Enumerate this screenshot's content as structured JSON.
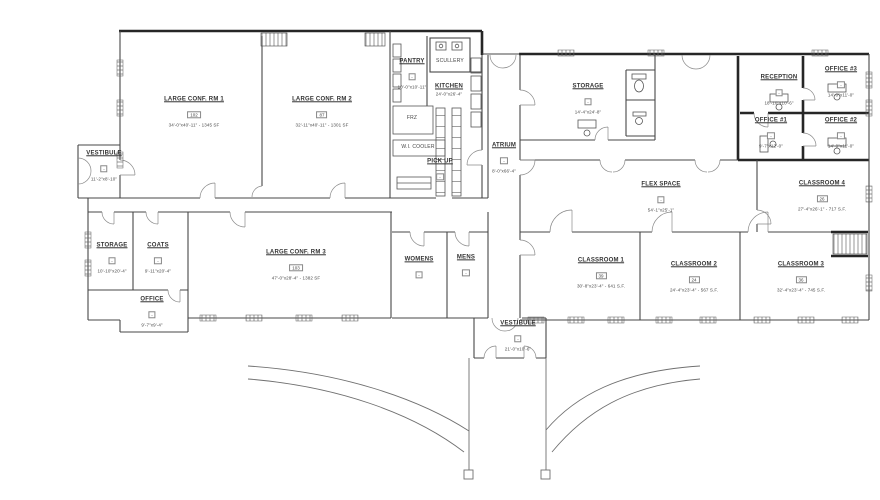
{
  "drawing": {
    "kind": "architectural floor plan",
    "background_color": "#ffffff",
    "line_color": "#4a4a4a",
    "thick_wall_color": "#262626",
    "canvas": {
      "width": 880,
      "height": 500
    }
  },
  "rooms": [
    {
      "type": "room",
      "name": "LARGE CONF. RM 1",
      "number": "102",
      "dims": "34'-0\"x40'-11\" - 1345 SF",
      "x": 194,
      "y": 112
    },
    {
      "type": "room",
      "name": "LARGE CONF. RM 2",
      "number": "87",
      "dims": "32'-11\"x40'-11\" - 1301 SF",
      "x": 322,
      "y": 112
    },
    {
      "type": "room",
      "name": "VESTIBULE",
      "number": "-",
      "dims": "11'-2\"x8'-10\"",
      "x": 104,
      "y": 166
    },
    {
      "type": "room",
      "name": "STORAGE",
      "number": "-",
      "dims": "10'-10\"x20'-4\"",
      "x": 112,
      "y": 258
    },
    {
      "type": "room",
      "name": "COATS",
      "number": "-",
      "dims": "9'-11\"x20'-4\"",
      "x": 158,
      "y": 258
    },
    {
      "type": "room",
      "name": "OFFICE",
      "number": "-",
      "dims": "9'-7\"x9'-4\"",
      "x": 152,
      "y": 312
    },
    {
      "type": "room",
      "name": "LARGE CONF. RM 3",
      "number": "103",
      "dims": "47'-0\"x28'-4\" - 1382 SF",
      "x": 296,
      "y": 265
    },
    {
      "type": "room",
      "name": "PANTRY",
      "number": "-",
      "dims": "10'-0\"x10'-11\"",
      "x": 412,
      "y": 74
    },
    {
      "type": "equip",
      "name": "SCULLERY",
      "number": "",
      "dims": "",
      "x": 450,
      "y": 62
    },
    {
      "type": "room",
      "name": "KITCHEN",
      "number": "",
      "dims": "24'-0\"x26'-4\"",
      "x": 449,
      "y": 90
    },
    {
      "type": "equip",
      "name": "FRZ",
      "number": "",
      "dims": "",
      "x": 412,
      "y": 119
    },
    {
      "type": "equip",
      "name": "W.I. COOLER",
      "number": "",
      "dims": "",
      "x": 418,
      "y": 148
    },
    {
      "type": "room",
      "name": "PICK UP",
      "number": "-",
      "dims": "",
      "x": 440,
      "y": 171
    },
    {
      "type": "room",
      "name": "ATRIUM",
      "number": "-",
      "dims": "8'-0\"x66'-4\"",
      "x": 504,
      "y": 158
    },
    {
      "type": "room",
      "name": "STORAGE",
      "number": "-",
      "dims": "14'-4\"x24'-8\"",
      "x": 588,
      "y": 99
    },
    {
      "type": "room",
      "name": "RECEPTION",
      "number": "-",
      "dims": "18'-10\"x10'-6\"",
      "x": 779,
      "y": 90
    },
    {
      "type": "room",
      "name": "OFFICE #3",
      "number": "-",
      "dims": "14'-0\"x11'-0\"",
      "x": 841,
      "y": 82
    },
    {
      "type": "room",
      "name": "OFFICE #1",
      "number": "-",
      "dims": "9'-7\"x12'-0\"",
      "x": 771,
      "y": 133
    },
    {
      "type": "room",
      "name": "OFFICE #2",
      "number": "-",
      "dims": "14'-0\"x11'-0\"",
      "x": 841,
      "y": 133
    },
    {
      "type": "room",
      "name": "FLEX SPACE",
      "number": "-",
      "dims": "54'-1\"x25'-1\"",
      "x": 661,
      "y": 197
    },
    {
      "type": "room",
      "name": "CLASSROOM 4",
      "number": "26",
      "dims": "27'-4\"x26'-1\" - 717 S.F.",
      "x": 822,
      "y": 196
    },
    {
      "type": "room",
      "name": "CLASSROOM 1",
      "number": "39",
      "dims": "30'-8\"x23'-4\" - 641 S.F.",
      "x": 601,
      "y": 273
    },
    {
      "type": "room",
      "name": "CLASSROOM 2",
      "number": "24",
      "dims": "24'-4\"x23'-4\" - 567 S.F.",
      "x": 694,
      "y": 277
    },
    {
      "type": "room",
      "name": "CLASSROOM 3",
      "number": "36",
      "dims": "32'-4\"x23'-4\" - 745 S.F.",
      "x": 801,
      "y": 277
    },
    {
      "type": "room",
      "name": "WOMENS",
      "number": "-",
      "dims": "",
      "x": 419,
      "y": 269
    },
    {
      "type": "room",
      "name": "MENS",
      "number": "-",
      "dims": "",
      "x": 466,
      "y": 267
    },
    {
      "type": "room",
      "name": "VESTIBULE",
      "number": "-",
      "dims": "21'-0\"x10'-6\"",
      "x": 518,
      "y": 336
    }
  ]
}
